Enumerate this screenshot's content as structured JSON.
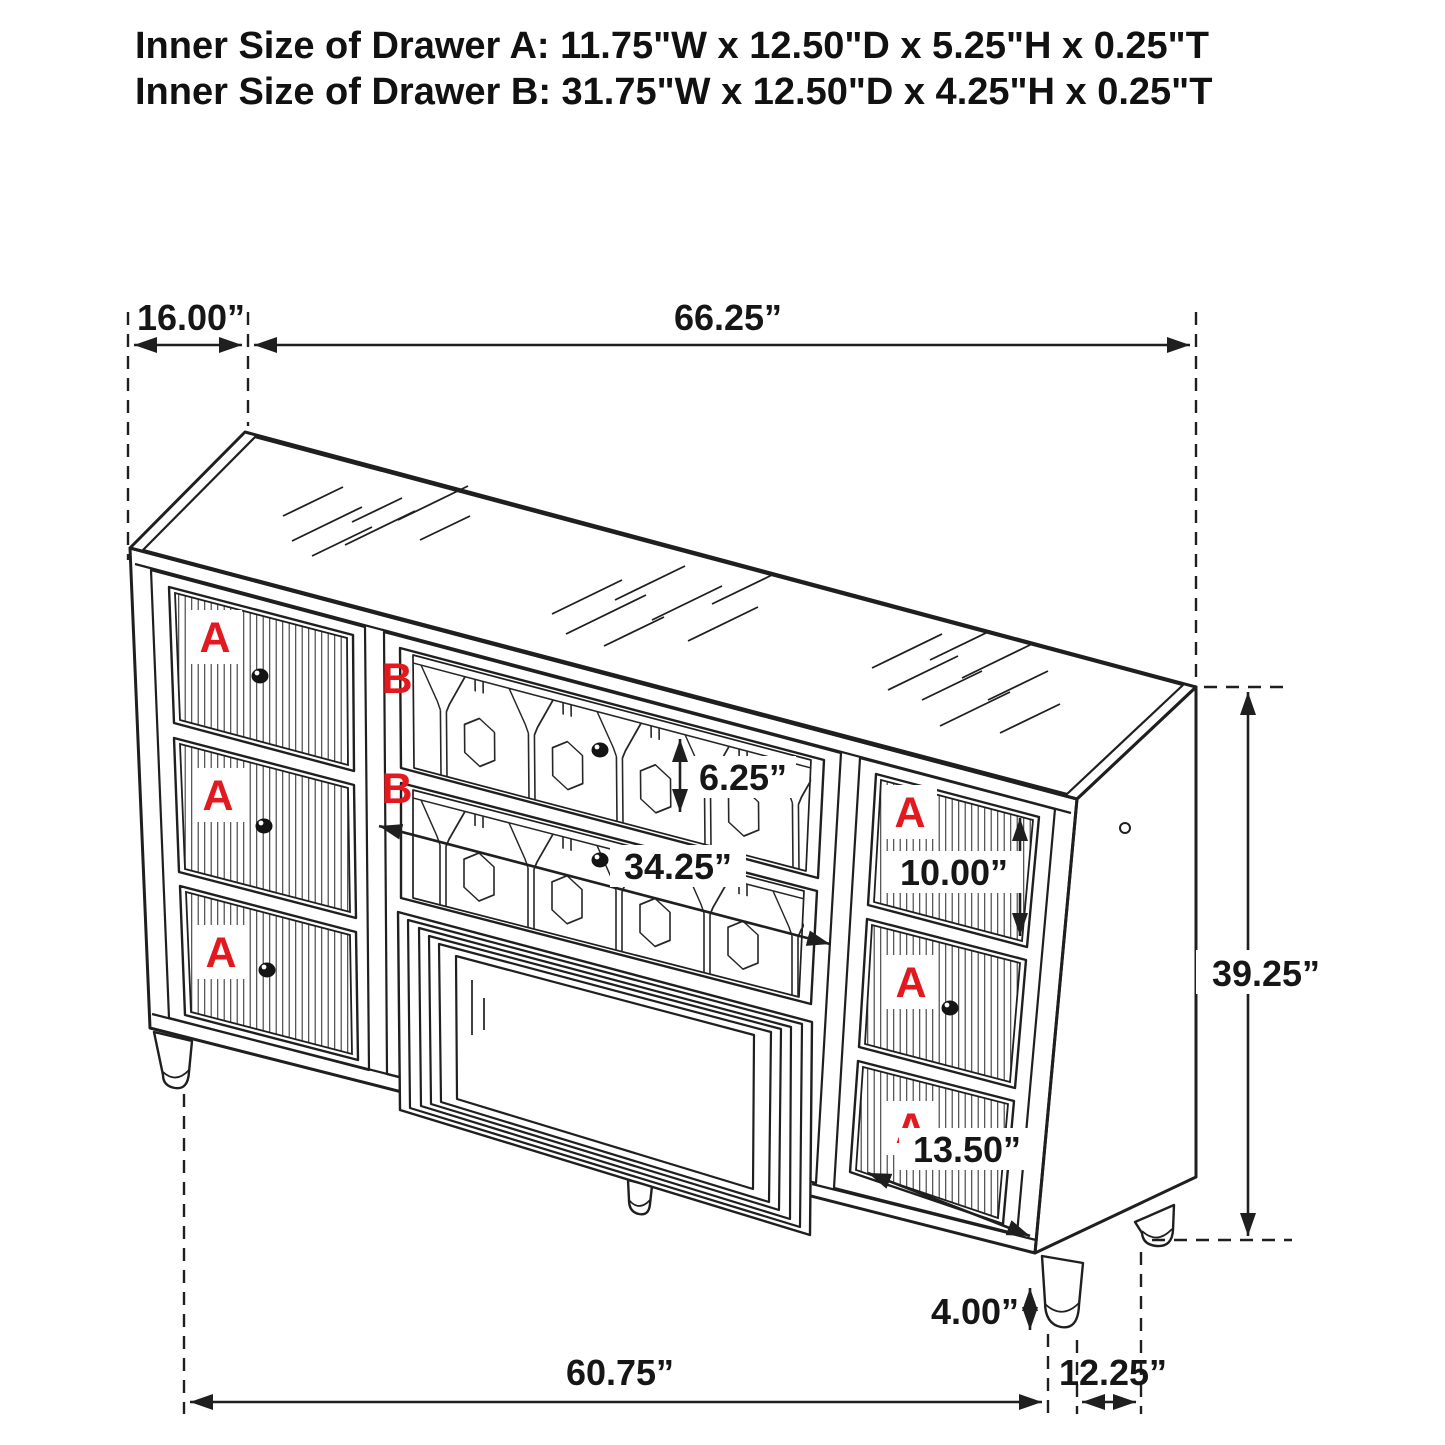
{
  "title": {
    "line_a": "Inner Size of Drawer A: 11.75\"W x 12.50\"D x 5.25\"H x 0.25\"T",
    "line_b": "Inner Size of Drawer B: 31.75\"W x 12.50\"D x 4.25\"H x 0.25\"T"
  },
  "drawer_labels": {
    "a": "A",
    "b": "B"
  },
  "dimensions": {
    "top_depth": "16.00”",
    "top_width": "66.25”",
    "b_drawer_front_height": "6.25”",
    "b_drawer_front_width": "34.25”",
    "a_drawer_right_front_height": "10.00”",
    "overall_height": "39.25”",
    "a_drawer_right_front_width": "13.50”",
    "leg_height": "4.00”",
    "base_width": "60.75”",
    "side_depth": "12.25”"
  },
  "colors": {
    "line": "#1f1f1f",
    "label_red": "#e2191f",
    "background": "#ffffff"
  }
}
